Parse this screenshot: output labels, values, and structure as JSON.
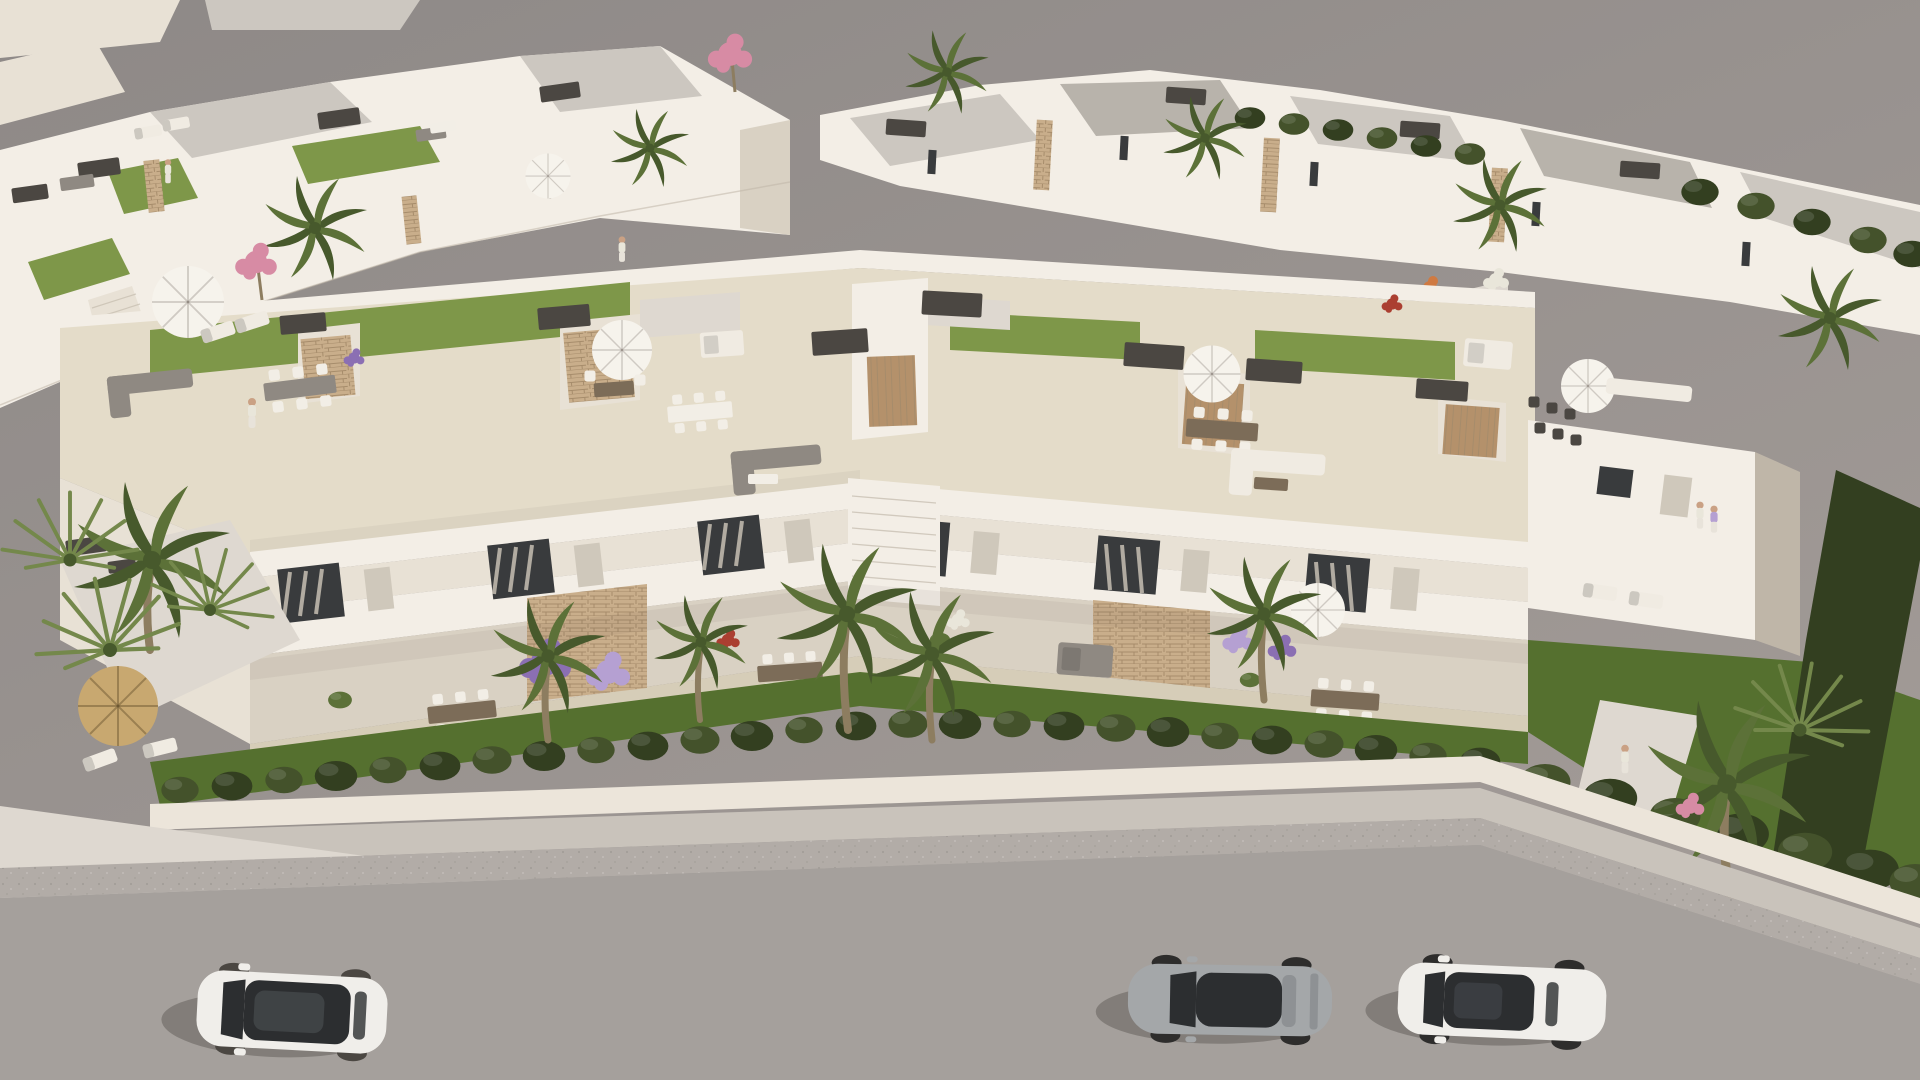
{
  "scene": {
    "type": "aerial-3d-architectural-render",
    "description": "Aerial 3D rendering of a modern white Mediterranean residential complex: a terraced row of townhouse modules with rooftop terraces, green lawns, parasols and outdoor furniture; rows of white villas behind; lush gardens, palm trees and a trimmed hedge in front; a street below with three parked cars.",
    "time_of_day": "sunny daylight",
    "background": "plain warm-gray ground plane"
  },
  "colors": {
    "bg1": "#8e8987",
    "bg2": "#a29b97",
    "wall": "#f3eee6",
    "wall2": "#e8e1d5",
    "wall3": "#d9d1c3",
    "wall4": "#bfb6a8",
    "roofg": "#ccc7c0",
    "roofgd": "#b8b3ab",
    "tile": "#e4dcc9",
    "tiled": "#d6cdb8",
    "lawn": "#7e9749",
    "lawnd": "#66803a",
    "lawnf": "#55702f",
    "hedge": "#44522b",
    "hedged": "#333f20",
    "stone": "#c9ae8b",
    "stoned": "#a68c6b",
    "wood": "#b4916b",
    "cap": "#4b4742",
    "glass": "#393b3d",
    "curtain": "#cfc8bb",
    "road": "#a5a09c",
    "roadedge": "#b2aca7",
    "walk": "#c9c3bb",
    "walkb": "#ded8d0",
    "lowwall": "#ece5da",
    "umb": "#f6f3ec",
    "thatch": "#c8a870",
    "sofag": "#8f8982",
    "sofaw": "#f0ebe2",
    "tableb": "#7c6c58",
    "tablew": "#f2eee6",
    "fpurple": "#8b6fb3",
    "flav": "#b5a0d2",
    "fpink": "#d78ba4",
    "forange": "#cf7a42",
    "fred": "#ab3f31",
    "fwhite": "#e9e6da",
    "palm": "#5c7138",
    "palmd": "#47592c",
    "palml": "#74884b",
    "trunk": "#8d7d60",
    "skin": "#caa184",
    "carwhite": "#f0eeea",
    "carsilver": "#a4a7a9",
    "tire": "#2e2d2c",
    "carglass": "#2c2e30",
    "shadow": "rgba(50,45,40,0.30)"
  },
  "regions": {
    "background": {
      "label": "Plain warm gray backdrop / ground plane"
    },
    "back_villas_left": {
      "label": "Back-left row of white villas with roof terraces, lawns, parasols and dark pergola boxes"
    },
    "back_villas_right": {
      "label": "Back-right rows of white flat-roofed villas with stone accents, hedges and palms"
    },
    "garden_band": {
      "label": "Landscaped garden walk with orange, purple and white flower beds between villa rows"
    },
    "main_building": {
      "label": "Foreground terraced apartment block of six white modules with rooftop terraces, balconies and ground-floor patios"
    },
    "rooftop_terraces": {
      "label": "Rooftop terraces with artificial lawn, parasols, loungers, sofas and dining sets"
    },
    "balcony_level": {
      "label": "First-floor balconies with louvered shutters, curtained sliding doors and flower planters"
    },
    "ground_terraces": {
      "label": "Ground-floor patios with wooden dining tables, daybeds and potted plants"
    },
    "front_garden": {
      "label": "Front lawn with trimmed hedge row, low white wall and tall palms"
    },
    "street": {
      "label": "Street with concrete sidewalk, rough shoulder band and gray asphalt"
    },
    "end_unit": {
      "label": "Right end unit with balcony, private garden and tall dark hedge"
    }
  },
  "vehicles": [
    {
      "name": "white-suv",
      "description": "White compact SUV with black panoramic glass roof, parked facing left",
      "body_color": "carwhite"
    },
    {
      "name": "silver-sports-coupe",
      "description": "Silver two-door sports coupe with dark cabin glass, parked facing left",
      "body_color": "carsilver"
    },
    {
      "name": "white-sedan",
      "description": "White sedan with black glass roof panel, parked facing left",
      "body_color": "carwhite"
    }
  ],
  "people": [
    {
      "name": "person-left-roof",
      "description": "Resident in white outfit walking on the left rooftop terrace"
    },
    {
      "name": "person-back-terrace",
      "description": "Resident on a rear villa terrace"
    },
    {
      "name": "couple-right-balcony",
      "description": "Couple standing on the right end-unit balcony"
    },
    {
      "name": "person-right-garden",
      "description": "Person walking on the right garden path"
    }
  ],
  "amenities": [
    "rooftop artificial lawns",
    "white parasols",
    "thatched tiki umbrella",
    "sun loungers",
    "gray and white outdoor sofa sets",
    "outdoor dining tables with chairs",
    "daybeds",
    "stone-clad stair towers with dark roof caps",
    "external staircases",
    "lavender and red flower planters",
    "barbecue corner",
    "gravel garden paths"
  ],
  "vegetation": {
    "palms_foreground": 7,
    "palms_background": 6,
    "hedge_row": "continuous trimmed hedge along the street wall",
    "flowering": [
      "pink bougainvillea trees",
      "lavender shrubs",
      "orange and white flower beds"
    ]
  }
}
